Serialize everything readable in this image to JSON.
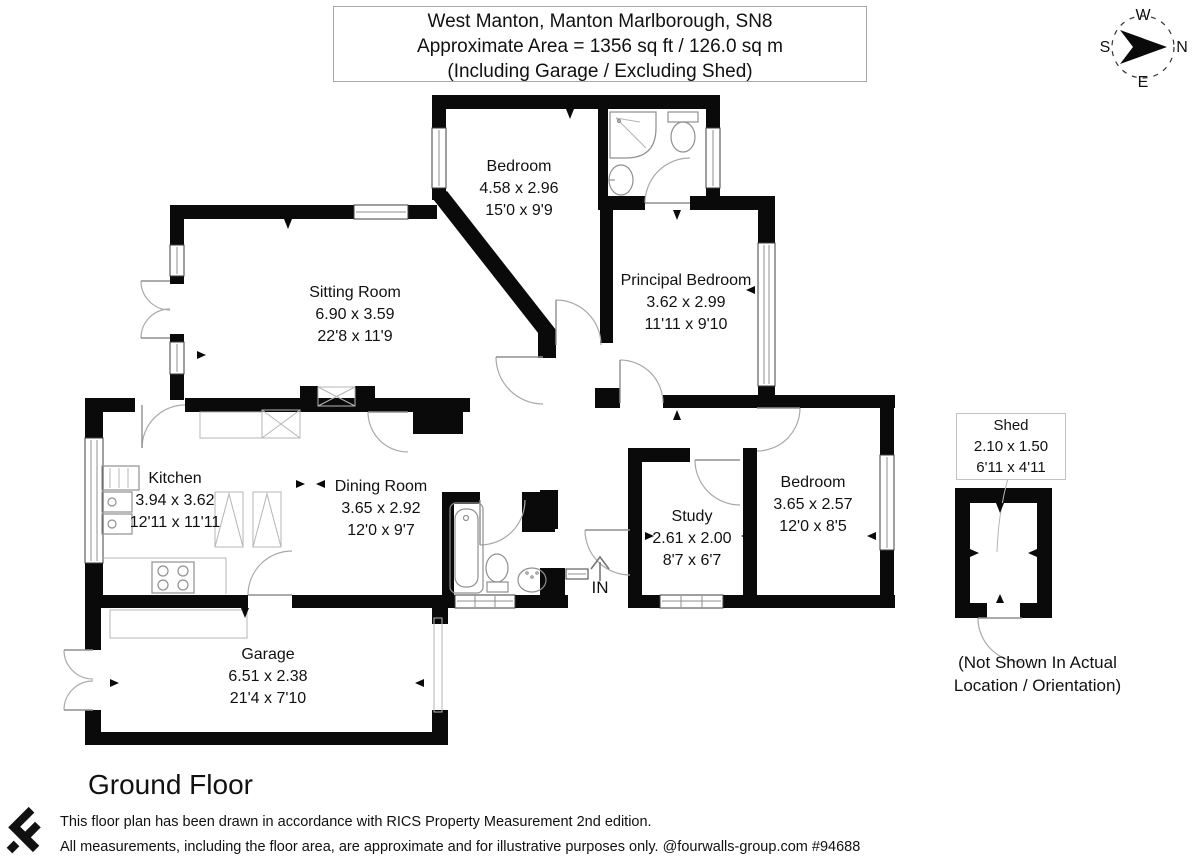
{
  "title_block": {
    "line1": "West Manton, Manton Marlborough, SN8",
    "line2": "Approximate Area = 1356 sq ft / 126.0 sq m",
    "line3": "(Including Garage / Excluding Shed)"
  },
  "compass": {
    "north": "N",
    "south": "S",
    "east": "E",
    "west": "W"
  },
  "rooms": [
    {
      "name": "Bedroom",
      "metric": "4.58 x 2.96",
      "imperial": "15'0 x 9'9"
    },
    {
      "name": "Sitting Room",
      "metric": "6.90 x 3.59",
      "imperial": "22'8 x 11'9"
    },
    {
      "name": "Principal Bedroom",
      "metric": "3.62 x 2.99",
      "imperial": "11'11 x 9'10"
    },
    {
      "name": "Kitchen",
      "metric": "3.94 x 3.62",
      "imperial": "12'11 x 11'11"
    },
    {
      "name": "Dining Room",
      "metric": "3.65 x 2.92",
      "imperial": "12'0 x 9'7"
    },
    {
      "name": "Study",
      "metric": "2.61 x 2.00",
      "imperial": "8'7 x 6'7"
    },
    {
      "name": "Bedroom",
      "metric": "3.65 x 2.57",
      "imperial": "12'0 x 8'5"
    },
    {
      "name": "Garage",
      "metric": "6.51 x 2.38",
      "imperial": "21'4 x 7'10"
    }
  ],
  "shed": {
    "name": "Shed",
    "metric": "2.10 x 1.50",
    "imperial": "6'11 x 4'11",
    "note_line1": "(Not Shown In Actual",
    "note_line2": "Location / Orientation)"
  },
  "entrance_label": "IN",
  "floor_label": "Ground Floor",
  "footer": {
    "line1": "This floor plan has been drawn in accordance with RICS Property Measurement 2nd edition.",
    "line2": "All measurements, including the floor area, are approximate and for illustrative purposes only. @fourwalls-group.com #94688"
  },
  "colors": {
    "wall": "#0a0a0a",
    "fixture": "#909090",
    "text": "#111111"
  }
}
